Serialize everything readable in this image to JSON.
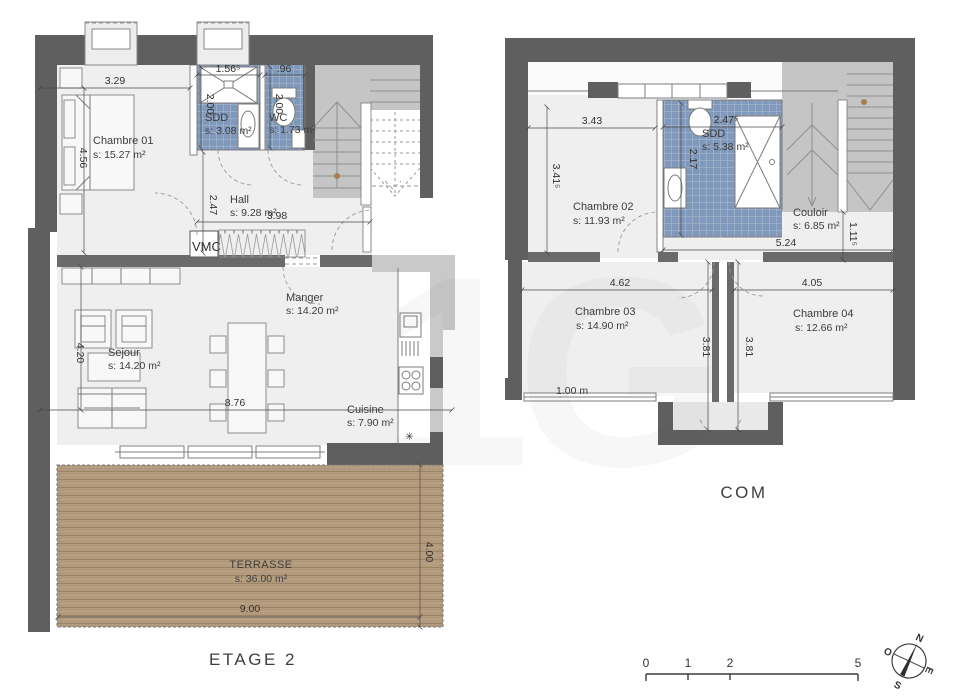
{
  "e2": {
    "title": "ETAGE 2",
    "vmc": "VMC",
    "snowflake": "✳",
    "rooms": {
      "ch01_name": "Chambre 01",
      "ch01_area": "s: 15.27 m²",
      "sdd_name": "SDD",
      "sdd_area": "s: 3.08 m²",
      "wc_name": "WC",
      "wc_area": "s: 1.73 m²",
      "hall_name": "Hall",
      "hall_area": "s: 9.28 m²",
      "manger_name": "Manger",
      "manger_area": "s: 14.20 m²",
      "sejour_name": "Sejour",
      "sejour_area": "s: 14.20 m²",
      "cuisine_name": "Cuisine",
      "cuisine_area": "s: 7.90 m²",
      "terrasse_name": "TERRASSE",
      "terrasse_area": "s: 36.00 m²"
    },
    "dims": {
      "d329": "3.29",
      "d156": "1.56⁵",
      "d96": ".96",
      "d456": "4.56",
      "d200a": "2.00",
      "d200b": "2.00",
      "d247": "2.47",
      "d398": "3.98",
      "d420": "4.20",
      "d876": "8.76",
      "d900": "9.00",
      "d400": "4.00"
    }
  },
  "com": {
    "title": "COM",
    "rooms": {
      "ch02_name": "Chambre 02",
      "ch02_area": "s: 11.93 m²",
      "sdd_name": "SDD",
      "sdd_area": "s: 5.38 m²",
      "couloir_name": "Couloir",
      "couloir_area": "s: 6.85 m²",
      "ch03_name": "Chambre 03",
      "ch03_area": "s: 14.90 m²",
      "ch04_name": "Chambre 04",
      "ch04_area": "s: 12.66 m²"
    },
    "dims": {
      "d343": "3.43",
      "d3415": "3.41⁵",
      "d2475": "2.47⁵",
      "d217": "2.17",
      "d524": "5.24",
      "d1115": "1.11⁵",
      "d462": "4.62",
      "d405": "4.05",
      "d381a": "3.81",
      "d381b": "3.81",
      "d100m": "1.00 m"
    }
  },
  "scalebar": {
    "t0": "0",
    "t1": "1",
    "t2": "2",
    "t5": "5"
  },
  "compass": {
    "n": "N",
    "e": "E",
    "s": "S",
    "o": "O"
  },
  "watermark": "1G",
  "colors": {
    "wall": "#5f5f60",
    "room_fill": "#efeff0",
    "tile_blue": "#8098ba",
    "stair_gray": "#c5c5c6",
    "terrace_wood": "#b39a7c",
    "dim_text": "#333333"
  }
}
